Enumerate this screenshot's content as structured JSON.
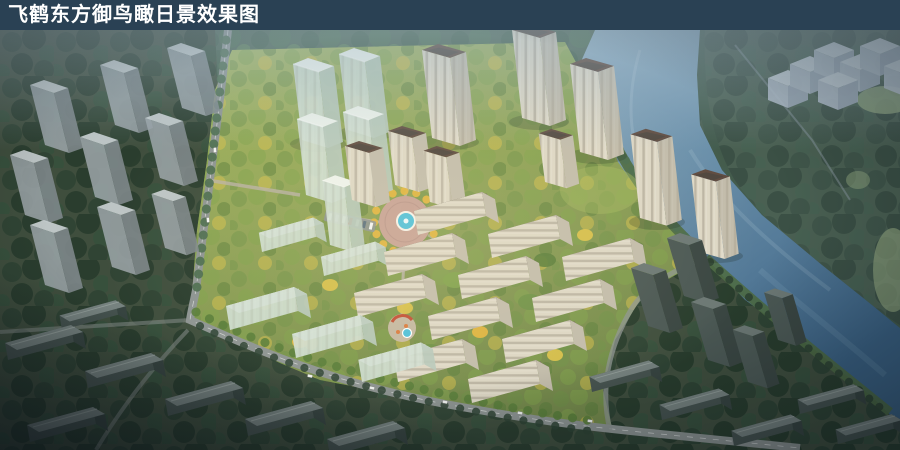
{
  "banner": {
    "title": "飞鹤东方御鸟瞰日景效果图"
  },
  "palette": {
    "banner_bg": "#2a4154",
    "text_white": "#ffffff",
    "land_base": "#45543f",
    "land_context": "#3f4e3d",
    "hill": "#4a6350",
    "farbank": "#3a4f3c",
    "tree_dark": "#2d4232",
    "tree_darker": "#263a2b",
    "tree_dark2": "#36503c",
    "tree_mid1": "#3f5c46",
    "tree_mid2": "#4a6b4e",
    "tree_mid3": "#597a52",
    "tree_b1": "#6e9147",
    "tree_b2": "#7fa24b",
    "tree_b3": "#597d3a",
    "tree_yellow": "#d8c04b",
    "tree_amber": "#e2b43e",
    "lawn1": "#a5b75f",
    "lawn2": "#74894a",
    "field": "#8ea372",
    "water_light": "#8faec2",
    "water_mid": "#6c91ab",
    "water_deep": "#3a6183",
    "bank_green": "#4c6a43",
    "road": "#8d9492",
    "road_light": "#b9b2a4",
    "plaza": "#c9a198",
    "pool": "#4ec0da",
    "facade_cream": "#ddd7c5",
    "facade_shade": "#c2bcab",
    "roof_brown": "#5f4b40",
    "roof_dark": "#4f463e",
    "roof_ridge": "#776b5f",
    "glass_front": "#cfddd1",
    "glass_side": "#b7c9bc",
    "glass_top": "#edf3ec",
    "gray_front": "#9aa3a6",
    "gray_side": "#7f898c",
    "gray_top": "#c4cbcc",
    "dark_front": "#45524e",
    "dark_side": "#374440",
    "dark_top": "#76827f",
    "dtower_front": "#4b5854",
    "dtower_side": "#3a4642",
    "dtower_top": "#6c7874",
    "cube_top": "#d3dae3",
    "cube_left": "#b6bfcc",
    "cube_right": "#9ea8b8",
    "haze": "#a3b9c8",
    "glow": "#ffeec0",
    "car_white": "#f2f4f2",
    "car_red": "#c0392b",
    "playground_red": "#c14f35",
    "playground_orange": "#d97b3f"
  }
}
